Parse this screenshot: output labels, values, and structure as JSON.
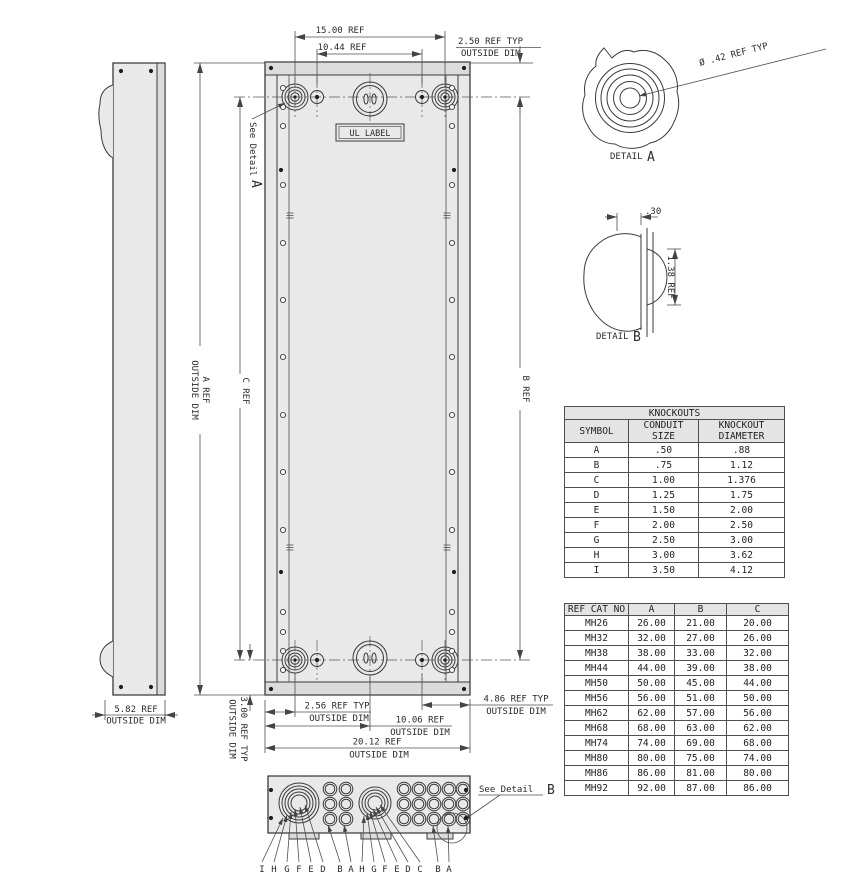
{
  "front_view": {
    "ul_label": "UL LABEL",
    "see_detail_a": {
      "text": "See Detail",
      "ref": "A"
    },
    "dims": {
      "top_width": "15.00 REF",
      "top_inner_width": "10.44 REF",
      "top_offset": {
        "l1": "2.50 REF TYP",
        "l2": "OUTSIDE DIM"
      },
      "height_a": {
        "l1": "A REF",
        "l2": "OUTSIDE DIM"
      },
      "height_c": "C REF",
      "height_b": "B REF",
      "bottom_offset": {
        "l1": "3.00 REF TYP",
        "l2": "OUTSIDE DIM"
      },
      "bottom_256": {
        "l1": "2.56 REF TYP",
        "l2": "OUTSIDE DIM"
      },
      "bottom_1006": {
        "l1": "10.06 REF",
        "l2": "OUTSIDE DIM"
      },
      "bottom_2012": {
        "l1": "20.12 REF",
        "l2": "OUTSIDE DIM"
      },
      "bottom_486": {
        "l1": "4.86 REF TYP",
        "l2": "OUTSIDE DIM"
      }
    }
  },
  "side_view": {
    "dim": {
      "l1": "5.82 REF",
      "l2": "OUTSIDE DIM"
    }
  },
  "detail_a": {
    "title": "DETAIL",
    "ref": "A",
    "dim": "Ø .42 REF TYP"
  },
  "detail_b": {
    "title": "DETAIL",
    "ref": "B",
    "dim_depth": ".30",
    "dim_height": "1.38 REF"
  },
  "bottom_view": {
    "see_detail": {
      "text": "See Detail",
      "ref": "B"
    },
    "labels": [
      "I",
      "H",
      "G",
      "F",
      "E",
      "D",
      "B",
      "A",
      "H",
      "G",
      "F",
      "E",
      "D",
      "C",
      "B",
      "A"
    ]
  },
  "knockouts_table": {
    "title": "KNOCKOUTS",
    "columns": [
      "SYMBOL",
      "CONDUIT\nSIZE",
      "KNOCKOUT\nDIAMETER"
    ],
    "rows": [
      [
        "A",
        ".50",
        ".88"
      ],
      [
        "B",
        ".75",
        "1.12"
      ],
      [
        "C",
        "1.00",
        "1.376"
      ],
      [
        "D",
        "1.25",
        "1.75"
      ],
      [
        "E",
        "1.50",
        "2.00"
      ],
      [
        "F",
        "2.00",
        "2.50"
      ],
      [
        "G",
        "2.50",
        "3.00"
      ],
      [
        "H",
        "3.00",
        "3.62"
      ],
      [
        "I",
        "3.50",
        "4.12"
      ]
    ]
  },
  "cat_table": {
    "columns": [
      "REF CAT NO",
      "A",
      "B",
      "C"
    ],
    "rows": [
      [
        "MH26",
        "26.00",
        "21.00",
        "20.00"
      ],
      [
        "MH32",
        "32.00",
        "27.00",
        "26.00"
      ],
      [
        "MH38",
        "38.00",
        "33.00",
        "32.00"
      ],
      [
        "MH44",
        "44.00",
        "39.00",
        "38.00"
      ],
      [
        "MH50",
        "50.00",
        "45.00",
        "44.00"
      ],
      [
        "MH56",
        "56.00",
        "51.00",
        "50.00"
      ],
      [
        "MH62",
        "62.00",
        "57.00",
        "56.00"
      ],
      [
        "MH68",
        "68.00",
        "63.00",
        "62.00"
      ],
      [
        "MH74",
        "74.00",
        "69.00",
        "68.00"
      ],
      [
        "MH80",
        "80.00",
        "75.00",
        "74.00"
      ],
      [
        "MH86",
        "86.00",
        "81.00",
        "80.00"
      ],
      [
        "MH92",
        "92.00",
        "87.00",
        "86.00"
      ]
    ]
  }
}
